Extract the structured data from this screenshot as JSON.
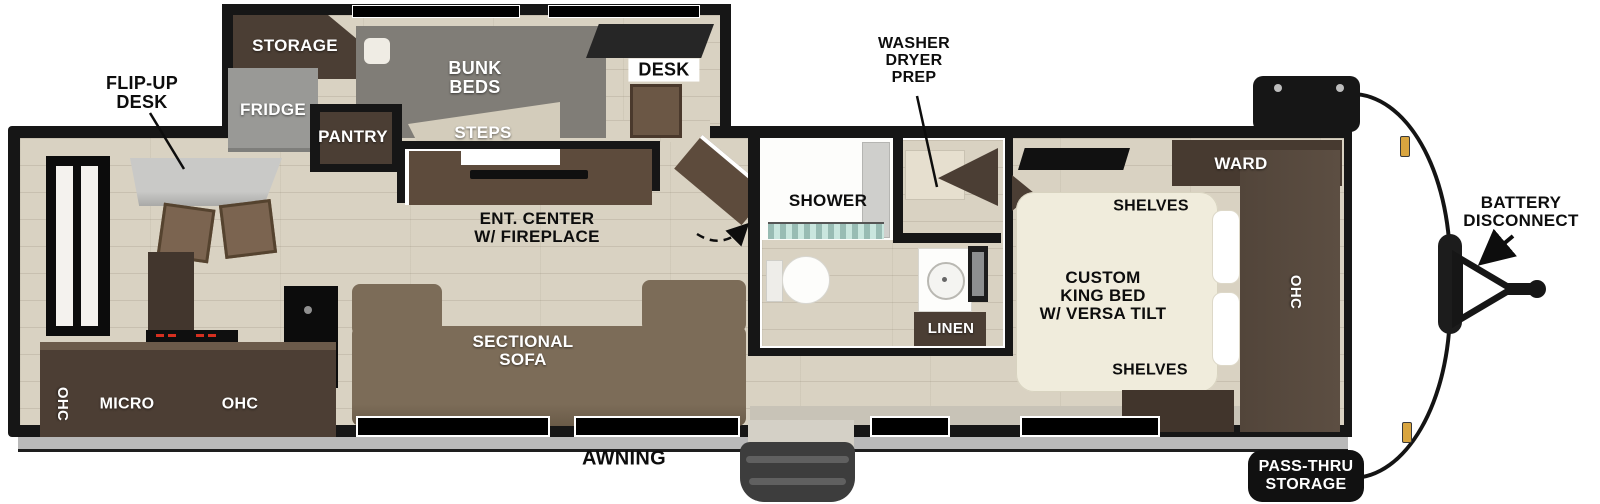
{
  "title": "Travel trailer floor plan",
  "labels": {
    "storage": "STORAGE",
    "flip_up_desk": "FLIP-UP\nDESK",
    "fridge": "FRIDGE",
    "pantry": "PANTRY",
    "bunk_beds": "BUNK\nBEDS",
    "steps": "STEPS",
    "desk": "DESK",
    "washer_dryer_prep": "WASHER\nDRYER\nPREP",
    "shower": "SHOWER",
    "ent_center": "ENT. CENTER\nW/ FIREPLACE",
    "sectional_sofa": "SECTIONAL\nSOFA",
    "ohc_kitchen_left": "OHC",
    "micro": "MICRO",
    "ohc_kitchen": "OHC",
    "linen": "LINEN",
    "ward": "WARD",
    "shelves_head": "SHELVES",
    "custom_king_bed": "CUSTOM\nKING BED\nW/ VERSA TILT",
    "shelves_foot": "SHELVES",
    "ohc_bedroom": "OHC",
    "awning": "AWNING",
    "battery_disconnect": "BATTERY\nDISCONNECT",
    "pass_thru_storage": "PASS-THRU\nSTORAGE"
  },
  "colors": {
    "wall_black": "#161616",
    "floor_plank": "#d9d2c2",
    "cabinet_dark_wood": "#4b3e34",
    "console_wood": "#5d4b3c",
    "sofa_brown": "#7c6c58",
    "furniture_gray": "#807d77",
    "bed_cream": "#f0ecdc",
    "shower_glass_teal": "#c9e6de",
    "marker_amber": "#d9a53f",
    "label_dark": "#0d0d0d",
    "label_light": "#ffffff"
  }
}
